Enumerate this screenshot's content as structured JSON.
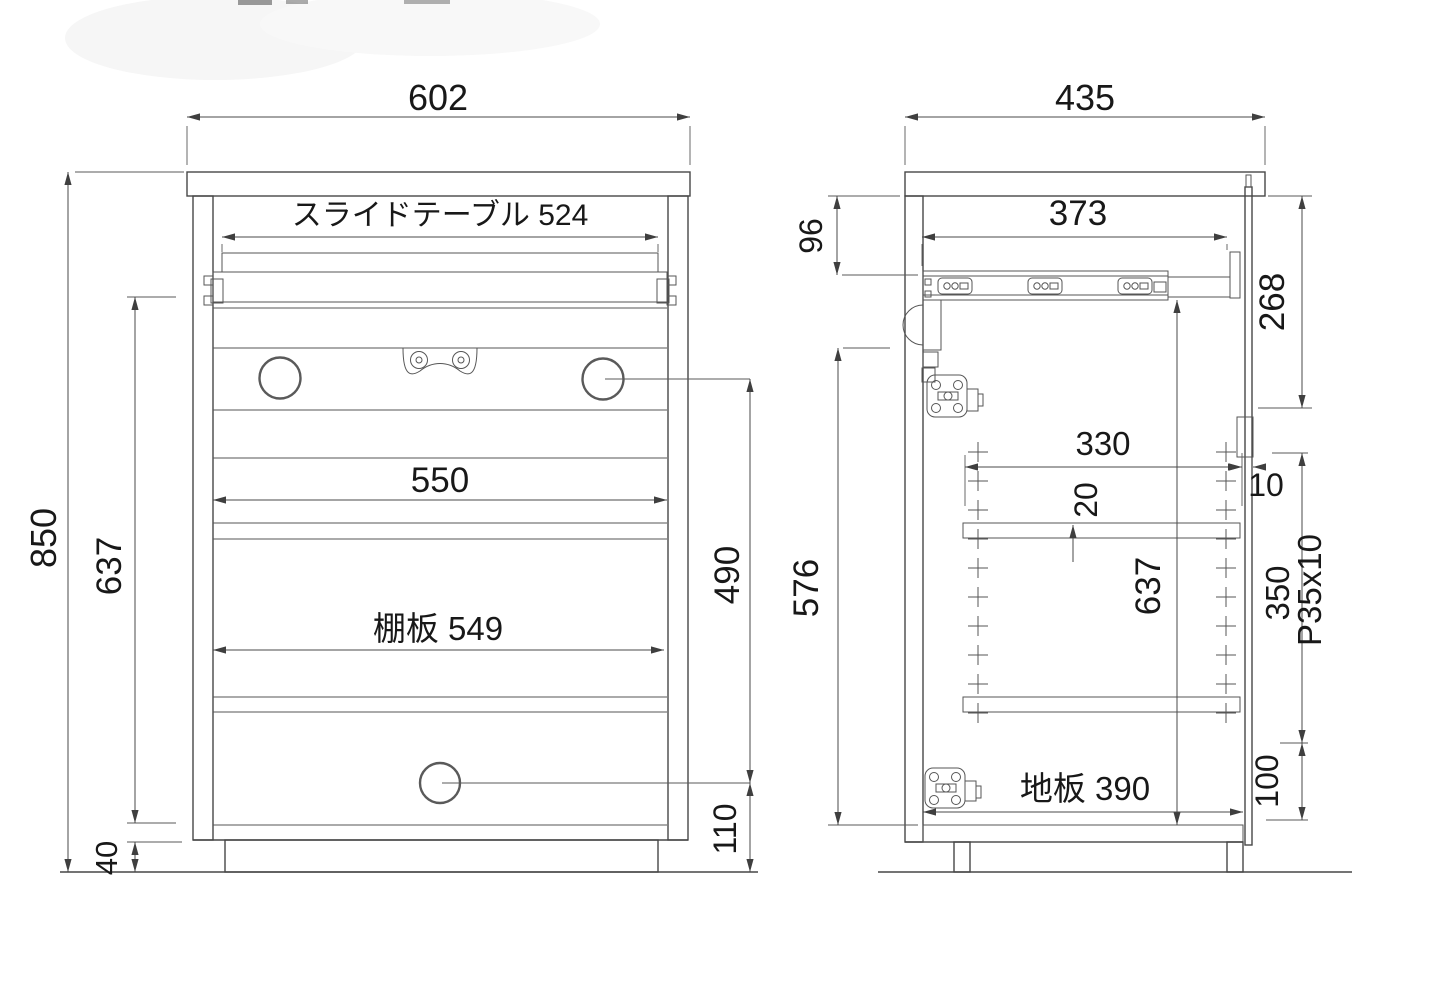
{
  "front_view": {
    "width": "602",
    "slide_table": "スライドテーブル 524",
    "inner_width": "550",
    "shelf_board": "棚板 549",
    "height": "850",
    "inner_height": "637",
    "hole_pitch_height": "490",
    "hole_to_floor": "110",
    "base_height": "40"
  },
  "side_view": {
    "depth": "435",
    "top_clearance": "96",
    "slide_rail_length": "373",
    "door_upper": "268",
    "shelf_depth": "330",
    "front_gap": "10",
    "shelf_thickness": "20",
    "inner_height": "637",
    "pin_span": "350",
    "pin_pitch": "P35x10",
    "back_inner_height": "576",
    "bottom_offset": "100",
    "bottom_board": "地板 390"
  }
}
